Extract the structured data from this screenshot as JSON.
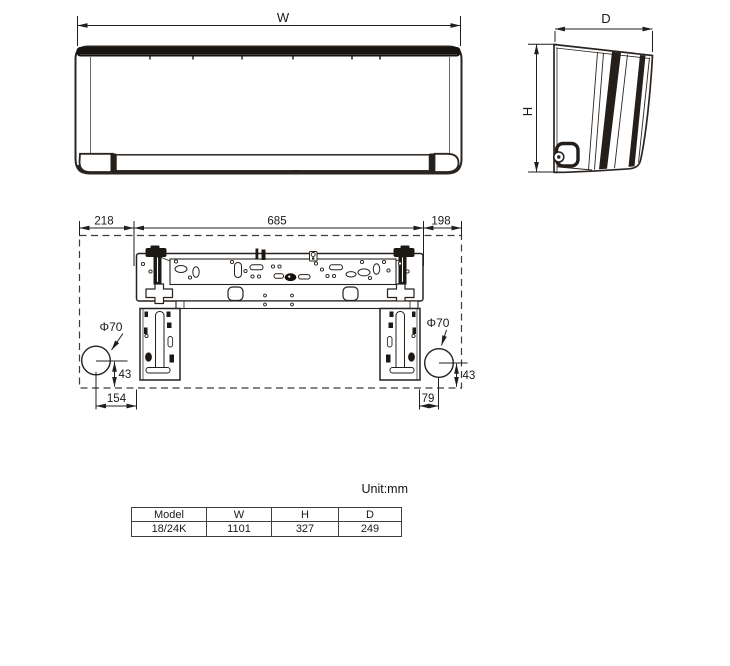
{
  "drawing": {
    "front": {
      "width_label": "W"
    },
    "side": {
      "depth_label": "D",
      "height_label": "H"
    },
    "mounting": {
      "dim_left_offset": "218",
      "dim_hook_span": "685",
      "dim_right_offset": "198",
      "pipe_hole_left": "Φ70",
      "pipe_hole_right": "Φ70",
      "dim_drop_left": "43",
      "dim_drop_right": "43",
      "dim_bottom_left": "154",
      "dim_bottom_right": "79"
    }
  },
  "table": {
    "unit_label": "Unit:mm",
    "headers": [
      "Model",
      "W",
      "H",
      "D"
    ],
    "rows": [
      [
        "18/24K",
        "1101",
        "327",
        "249"
      ]
    ]
  }
}
